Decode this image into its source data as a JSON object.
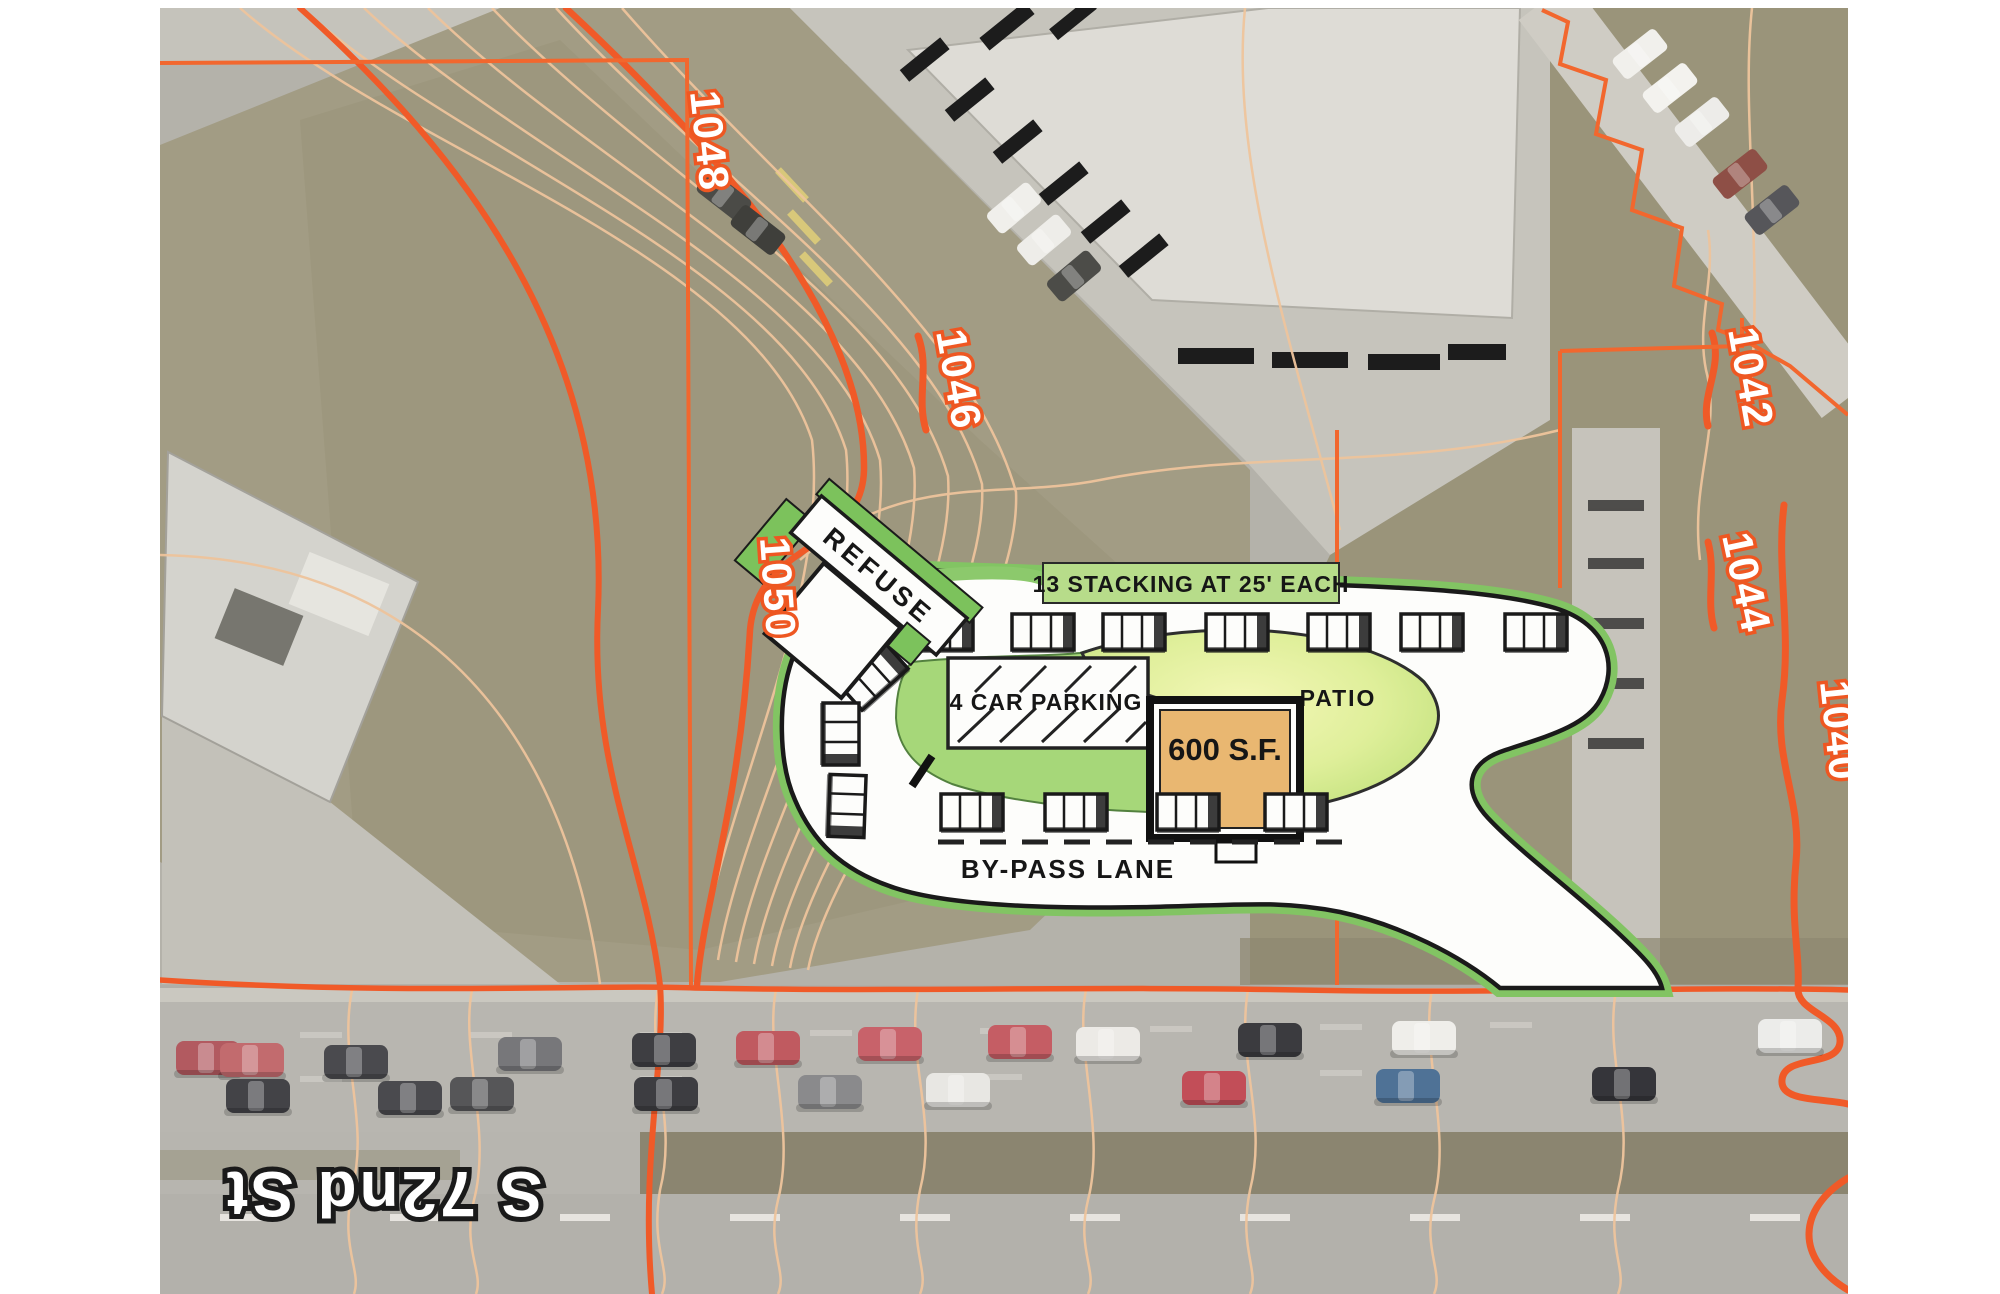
{
  "plan": {
    "refuse": "REFUSE",
    "stacking": "13 STACKING  AT 25' EACH",
    "car_parking": "4 CAR PARKING",
    "patio": "PATIO",
    "building_area": "600 S.F.",
    "bypass_lane": "BY-PASS LANE"
  },
  "contours": {
    "elev_1048": "1048",
    "elev_1046": "1046",
    "elev_1050": "1050",
    "elev_1042": "1042",
    "elev_1044": "1044",
    "elev_1040": "1040"
  },
  "street": {
    "name": "S 72nd St"
  },
  "colors": {
    "contour_thick": "#f05a28",
    "contour_thin": "#eec49c",
    "boundary_orange": "#f2672e",
    "site_green": "#a6d779",
    "stacking_band": "#b7dc8a",
    "patio_fill": "#eef3ae",
    "building_fill": "#e9b771",
    "asphalt_white": "#fdfdfb"
  },
  "vehicles": {
    "road_upper_row_colors": [
      "red",
      "red",
      "dark",
      "gray",
      "dark",
      "red",
      "red",
      "red",
      "white",
      "dark-suv",
      "white",
      "white"
    ],
    "road_lower_row_colors": [
      "dark",
      "dark",
      "dark",
      "dark",
      "gray",
      "white",
      "red",
      "blue",
      "dark"
    ]
  }
}
